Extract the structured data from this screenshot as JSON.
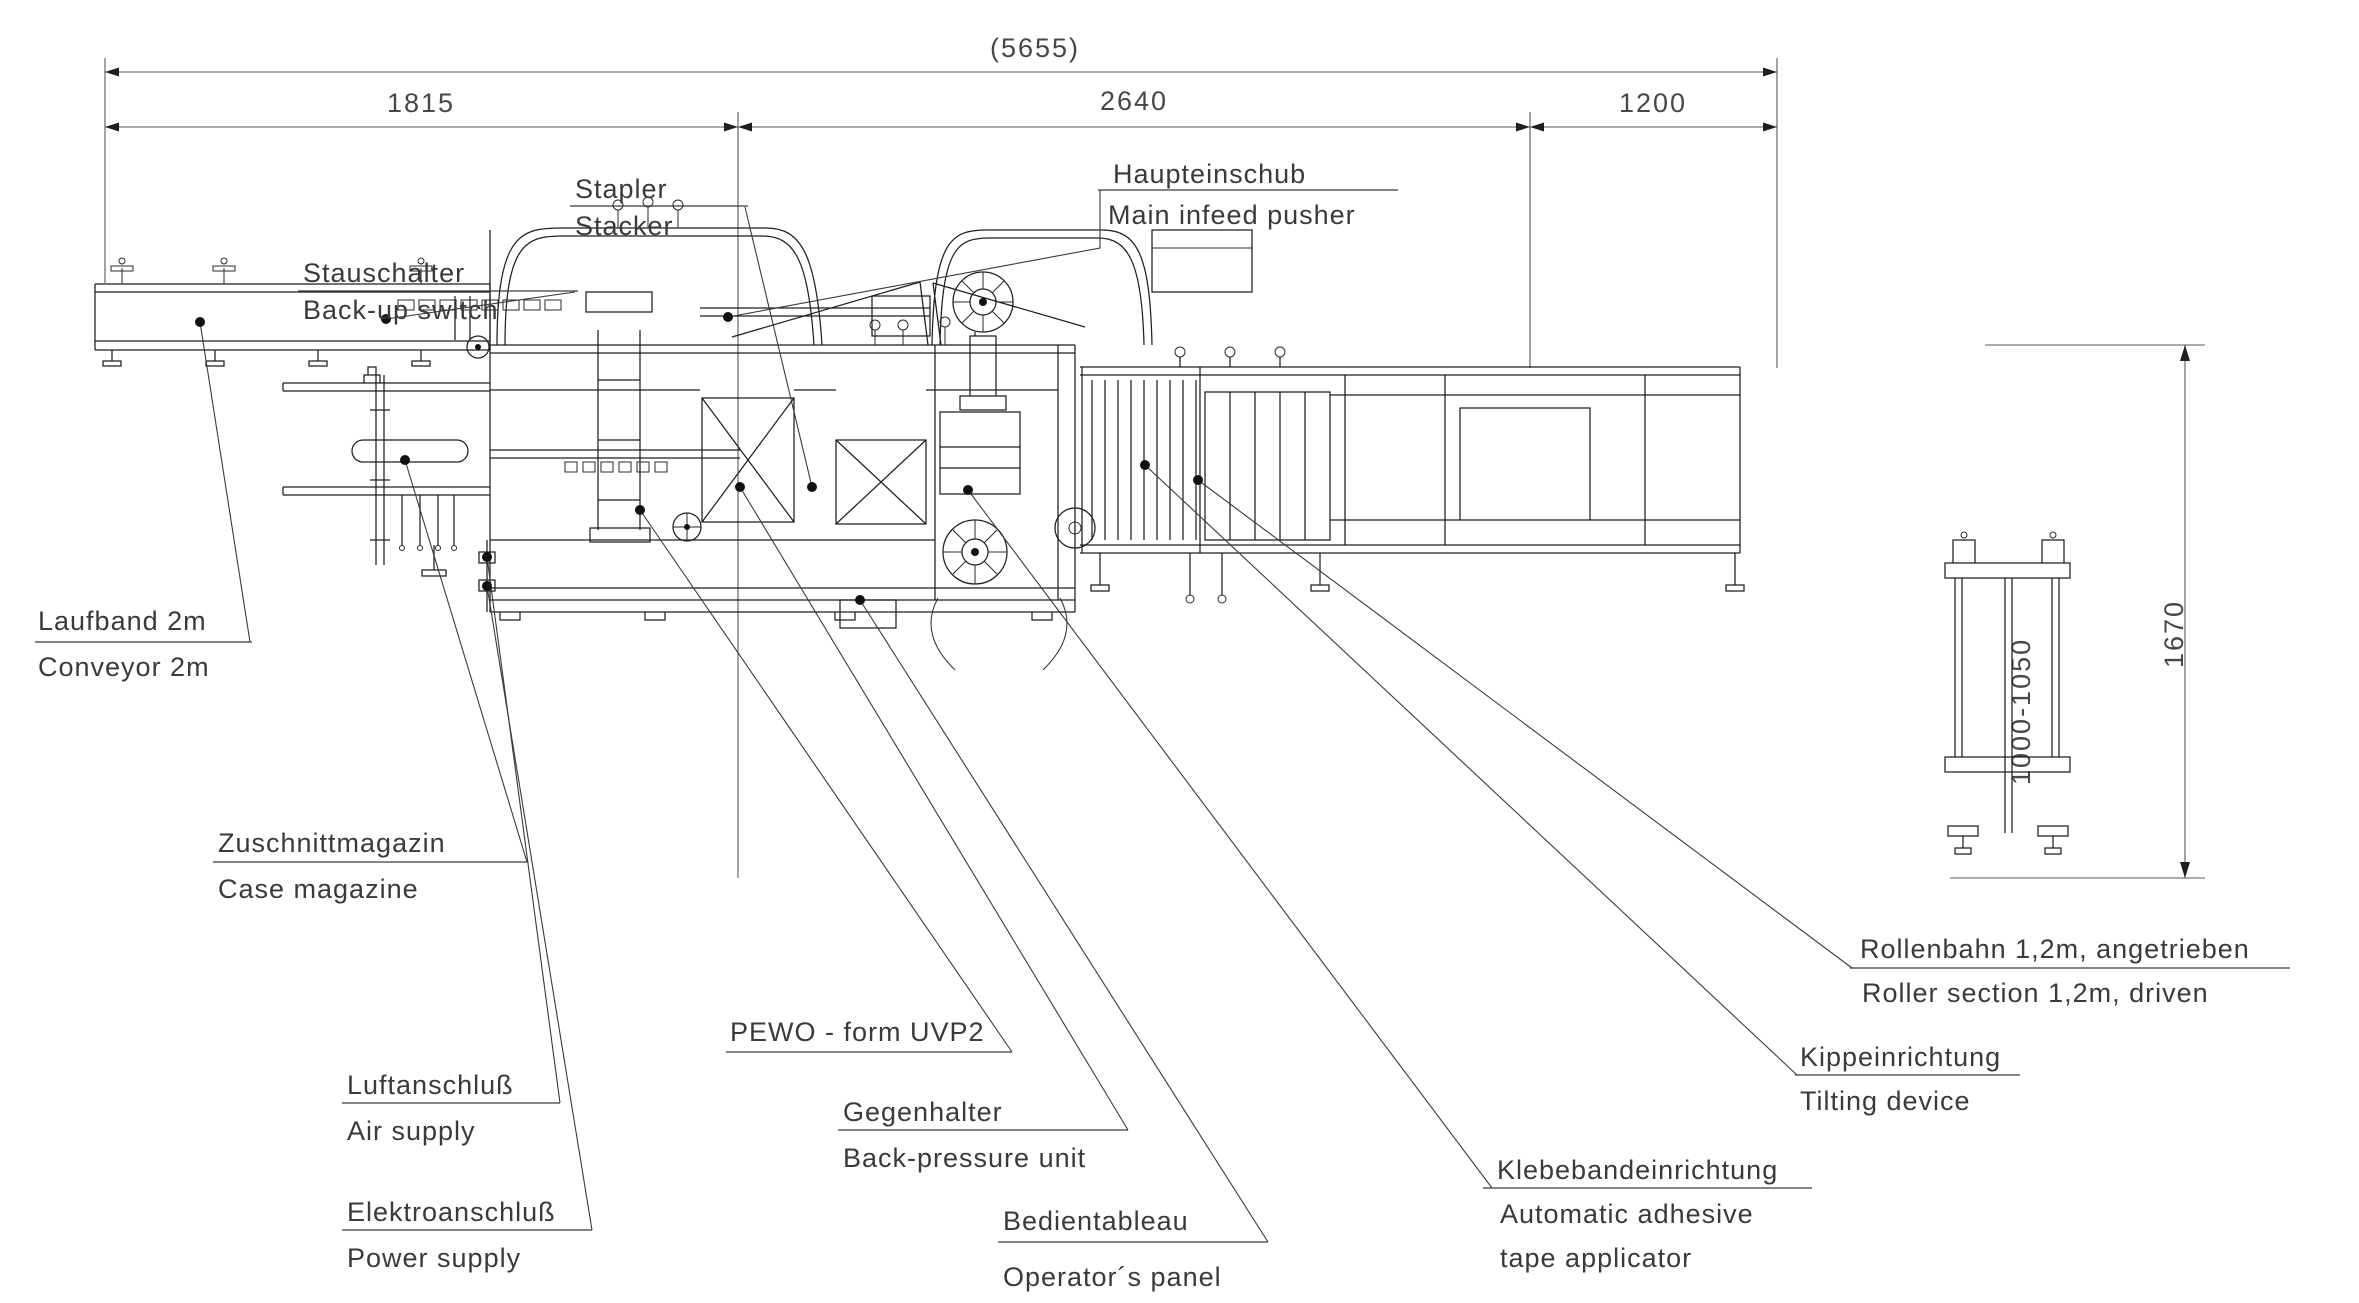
{
  "drawing": {
    "machine_name": "PEWO - form UVP2",
    "style": {
      "ink": "#1f1f1f",
      "dim_ink": "#4a4a4a",
      "background": "#ffffff"
    }
  },
  "dimensions": {
    "total_length": "(5655)",
    "segment_left": "1815",
    "segment_middle": "2640",
    "segment_right": "1200",
    "overall_height": "1670",
    "roller_height_range": "1000-1050"
  },
  "labels": {
    "stauschalter": {
      "de": "Stauschalter",
      "en": "Back-up switch"
    },
    "stapler": {
      "de": "Stapler",
      "en": "Stacker"
    },
    "haupteinschub": {
      "de": "Haupteinschub",
      "en": "Main infeed pusher"
    },
    "laufband": {
      "de": "Laufband 2m",
      "en": "Conveyor 2m"
    },
    "zuschnittmagazin": {
      "de": "Zuschnittmagazin",
      "en": "Case magazine"
    },
    "luftanschluss": {
      "de": "Luftanschluß",
      "en": "Air supply"
    },
    "elektroanschluss": {
      "de": "Elektroanschluß",
      "en": "Power supply"
    },
    "pewo": {
      "de": "PEWO - form UVP2"
    },
    "gegenhalter": {
      "de": "Gegenhalter",
      "en": "Back-pressure unit"
    },
    "bedientableau": {
      "de": "Bedientableau",
      "en": "Operator´s panel"
    },
    "klebeband": {
      "de": "Klebebandeinrichtung",
      "en1": "Automatic adhesive",
      "en2": "tape applicator"
    },
    "kippeinrichtung": {
      "de": "Kippeinrichtung",
      "en": "Tilting device"
    },
    "rollenbahn": {
      "de": "Rollenbahn 1,2m, angetrieben",
      "en": "Roller section 1,2m, driven"
    }
  }
}
